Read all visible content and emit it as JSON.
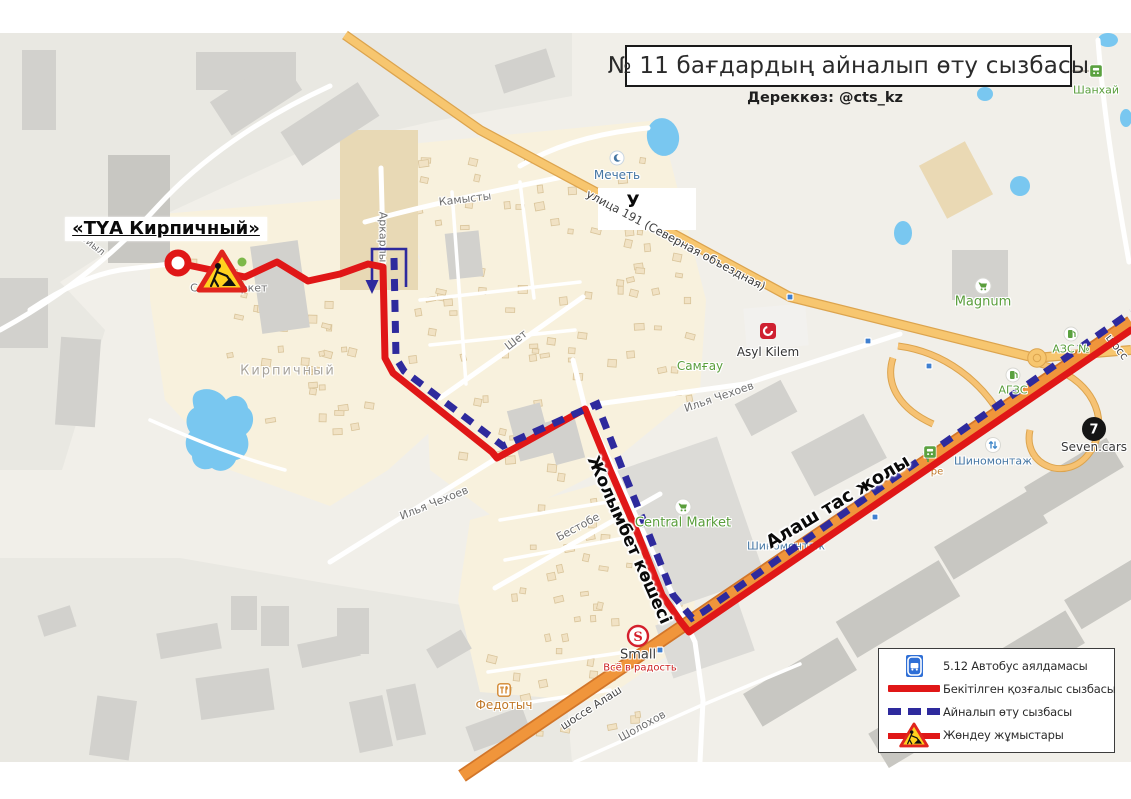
{
  "title": "№ 11 бағдардың айналып өту сызбасы",
  "source": "Дереккөз: @cts_kz",
  "legend": {
    "items": [
      {
        "id": "bus-stop",
        "label": "5.12 Автобус аялдамасы"
      },
      {
        "id": "approved-route",
        "label": "Бекітілген қозғалыс сызбасы"
      },
      {
        "id": "detour-route",
        "label": "Айналып өту сызбасы"
      },
      {
        "id": "roadworks",
        "label": "Жөндеу жұмыстары"
      }
    ]
  },
  "colors": {
    "approved_route": "#e01717",
    "detour_route": "#2e2a9d",
    "highway": "#f0953b",
    "water": "#79c7f0",
    "poi_green": "#5a9e3c",
    "poi_blue": "#4576a3"
  },
  "street_labels": [
    {
      "text": "Ойыл",
      "x": 92,
      "y": 245,
      "rot": 38,
      "size": 10
    },
    {
      "text": "Кирпичный",
      "x": 288,
      "y": 371,
      "rot": 0,
      "size": 13,
      "color": "#a8a49c",
      "spacing": 2
    },
    {
      "text": "Аркарлы",
      "x": 383,
      "y": 237,
      "rot": 90,
      "size": 11
    },
    {
      "text": "Камысты",
      "x": 465,
      "y": 199,
      "rot": -7,
      "size": 11
    },
    {
      "text": "Шет",
      "x": 516,
      "y": 340,
      "rot": -38,
      "size": 11
    },
    {
      "text": "Илья Чехоев",
      "x": 434,
      "y": 503,
      "rot": -22,
      "size": 11
    },
    {
      "text": "Илья Чехоев",
      "x": 719,
      "y": 397,
      "rot": -19,
      "size": 11
    },
    {
      "text": "Бестобе",
      "x": 578,
      "y": 527,
      "rot": -28,
      "size": 11
    },
    {
      "text": "улица 191 (Северная объездная)",
      "x": 676,
      "y": 240,
      "rot": 28,
      "size": 11.5,
      "color": "#3d3d3d"
    },
    {
      "text": "шоссе Алаш",
      "x": 591,
      "y": 708,
      "rot": -33,
      "size": 11,
      "color": "#454545"
    },
    {
      "text": "Шолохов",
      "x": 642,
      "y": 726,
      "rot": -29,
      "size": 11
    },
    {
      "text": "Шиномонтаж",
      "x": 786,
      "y": 546,
      "rot": 0,
      "size": 11,
      "color": "#4576a3"
    },
    {
      "text": "С",
      "x": 194,
      "y": 288,
      "rot": 0,
      "size": 11
    },
    {
      "text": "ркет",
      "x": 254,
      "y": 288,
      "rot": 0,
      "size": 11
    },
    {
      "text": "ре",
      "x": 937,
      "y": 472,
      "rot": 0,
      "size": 10,
      "color": "#c07828"
    },
    {
      "text": "шосс",
      "x": 1117,
      "y": 347,
      "rot": 52,
      "size": 11,
      "color": "#454545"
    }
  ],
  "pois": [
    {
      "icon": "mosque",
      "label": "Мечеть",
      "x": 617,
      "y": 158,
      "ly": 175,
      "color": "#4576a3",
      "size": 12
    },
    {
      "icon": "cart",
      "label": "Magnum",
      "x": 983,
      "y": 286,
      "ly": 302,
      "color": "#5a9e3c",
      "size": 13
    },
    {
      "icon": "cart",
      "label": "Central Market",
      "x": 683,
      "y": 507,
      "ly": 523,
      "color": "#5a9e3c",
      "size": 13
    },
    {
      "label": "Самғау",
      "x": 700,
      "ly": 366,
      "color": "#5a9e3c",
      "size": 12
    },
    {
      "icon": "stop",
      "label": "Шанхай",
      "x": 1096,
      "y": 71,
      "ly": 90,
      "color": "#5a9e3c",
      "size": 11
    },
    {
      "icon": "fuel",
      "label": "АЗС №",
      "x": 1071,
      "y": 334,
      "ly": 349,
      "color": "#5a9e3c",
      "size": 11
    },
    {
      "icon": "fuel",
      "label": "АГЗС",
      "x": 1013,
      "y": 375,
      "ly": 390,
      "color": "#5a9e3c",
      "size": 11
    },
    {
      "icon": "tire",
      "label": "Шиномонтаж",
      "x": 993,
      "y": 445,
      "ly": 461,
      "color": "#4576a3",
      "size": 11
    },
    {
      "icon": "seven",
      "label": "Seven.cars",
      "x": 1094,
      "y": 429,
      "ly": 447,
      "color": "#3a3a3a",
      "size": 12
    },
    {
      "icon": "asyl",
      "label": "Asyl Kilem",
      "x": 768,
      "y": 331,
      "ly": 352,
      "color": "#333333",
      "size": 12
    },
    {
      "icon": "smalllogo",
      "label": "Small",
      "x": 638,
      "y": 636,
      "ly": 655,
      "color": "#3a3a3a",
      "size": 13,
      "sub": "Всё в радость",
      "subcolor": "#cc2222",
      "subsize": 10
    },
    {
      "icon": "rest",
      "label": "Федотыч",
      "x": 504,
      "y": 690,
      "ly": 705,
      "color": "#c07828",
      "size": 12
    },
    {
      "icon": "stop",
      "x": 930,
      "y": 452
    }
  ],
  "annotations": [
    {
      "text": "«ТҮА Кирпичный»",
      "x": 166,
      "y": 229,
      "rot": 0,
      "size": 18,
      "boxed": true
    },
    {
      "text": "У",
      "x": 633,
      "y": 202,
      "rot": 0,
      "size": 17
    },
    {
      "text": "Жолымбет көшесі",
      "x": 629,
      "y": 540,
      "rot": 66,
      "size": 17
    },
    {
      "text": "Алаш тас жолы",
      "x": 838,
      "y": 502,
      "rot": -31,
      "size": 18
    }
  ]
}
